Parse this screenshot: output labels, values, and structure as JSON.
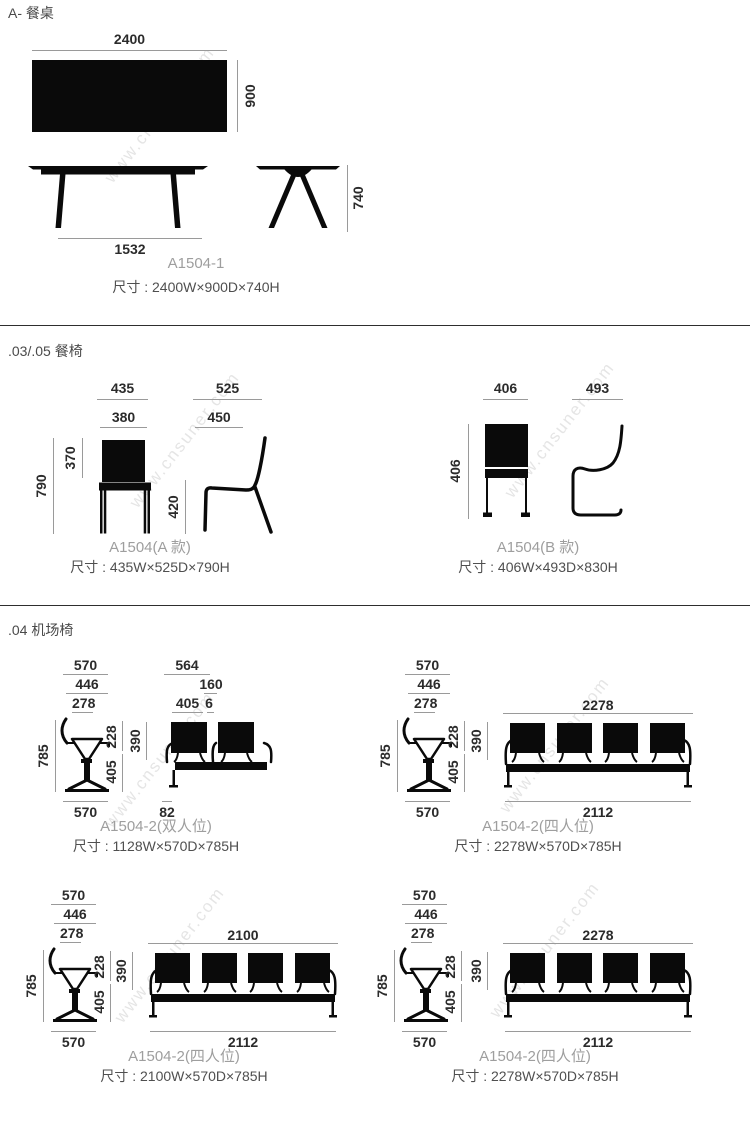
{
  "page": {
    "watermark": "www.cnsuner.com",
    "ink_color": "#0a0a0a",
    "dim_line_color": "#9a9a9a"
  },
  "s1": {
    "heading": "A- 餐桌",
    "top_width": "2400",
    "top_depth": "900",
    "front_base": "1532",
    "side_height": "740",
    "model": "A1504-1",
    "size": "尺寸 : 2400W×900D×740H"
  },
  "s2": {
    "heading": ".03/.05 餐椅",
    "a": {
      "front_w_outer": "435",
      "front_w_inner": "380",
      "front_h": "790",
      "front_back_h": "370",
      "side_d_outer": "525",
      "side_d_inner": "450",
      "side_seat_h": "420",
      "model": "A1504(A 款)",
      "size": "尺寸 : 435W×525D×790H"
    },
    "b": {
      "front_w": "406",
      "front_h": "406",
      "side_d": "493",
      "model": "A1504(B 款)",
      "size": "尺寸 : 406W×493D×830H"
    }
  },
  "s3": {
    "heading": ".04 机场椅",
    "side_dims": {
      "w1": "570",
      "w2": "446",
      "w3": "278",
      "h": "785",
      "back_h": "228",
      "seat_h": "405",
      "base_w": "570"
    },
    "groups": [
      {
        "front_top": "564",
        "front_top2": "160",
        "front_top3a": "405",
        "front_top3b": "6",
        "back_h": "390",
        "front_base": "82",
        "model": "A1504-2(双人位)",
        "size": "尺寸 : 1128W×570D×785H"
      },
      {
        "front_top": "2278",
        "back_h": "390",
        "front_base": "2112",
        "model": "A1504-2(四人位)",
        "size": "尺寸 : 2278W×570D×785H"
      },
      {
        "front_top": "2100",
        "back_h": "390",
        "front_base": "2112",
        "model": "A1504-2(四人位)",
        "size": "尺寸 : 2100W×570D×785H"
      },
      {
        "front_top": "2278",
        "back_h": "390",
        "front_base": "2112",
        "model": "A1504-2(四人位)",
        "size": "尺寸 : 2278W×570D×785H"
      }
    ]
  }
}
